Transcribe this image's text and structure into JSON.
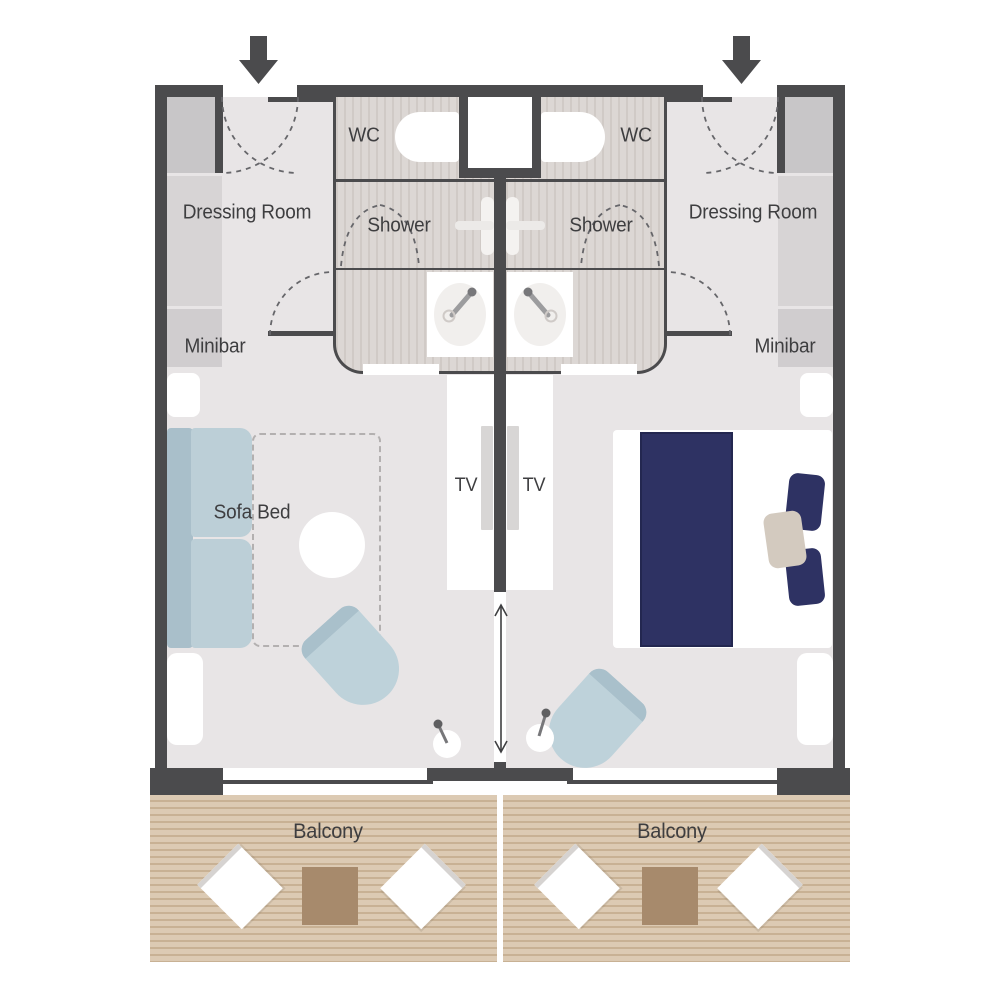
{
  "title": "Two connecting cabins floor plan",
  "cabin_left": {
    "dressing_room_label": "Dressing Room",
    "minibar_label": "Minibar",
    "wc_label": "WC",
    "shower_label": "Shower",
    "sofa_bed_label": "Sofa Bed",
    "tv_label": "TV",
    "balcony_label": "Balcony"
  },
  "cabin_right": {
    "dressing_room_label": "Dressing Room",
    "minibar_label": "Minibar",
    "wc_label": "WC",
    "shower_label": "Shower",
    "tv_label": "TV",
    "balcony_label": "Balcony"
  },
  "icons": {
    "entry_arrow": "down-arrow",
    "connecting_door_arrow": "double-vertical-arrow",
    "toilet": "wc-toilet",
    "washbasin": "sink-with-faucet",
    "shower_mixer": "shower-control-cross",
    "floor_lamp": "lamp",
    "tv": "wall-mounted-tv",
    "door_swing": "dashed-arc"
  },
  "colors": {
    "wall": "#4b4b4d",
    "room_floor": "#e8e5e6",
    "bathroom_floor": "#dcd7d4",
    "bed_navy": "#2e3263",
    "sofa_blue": "#bccfd7",
    "cushion_beige": "#d3cabf",
    "deck_tan": "#dccab3",
    "deck_stripe": "#c8b194",
    "table_brown": "#a78a6c",
    "label_text": "#3e3e40"
  }
}
